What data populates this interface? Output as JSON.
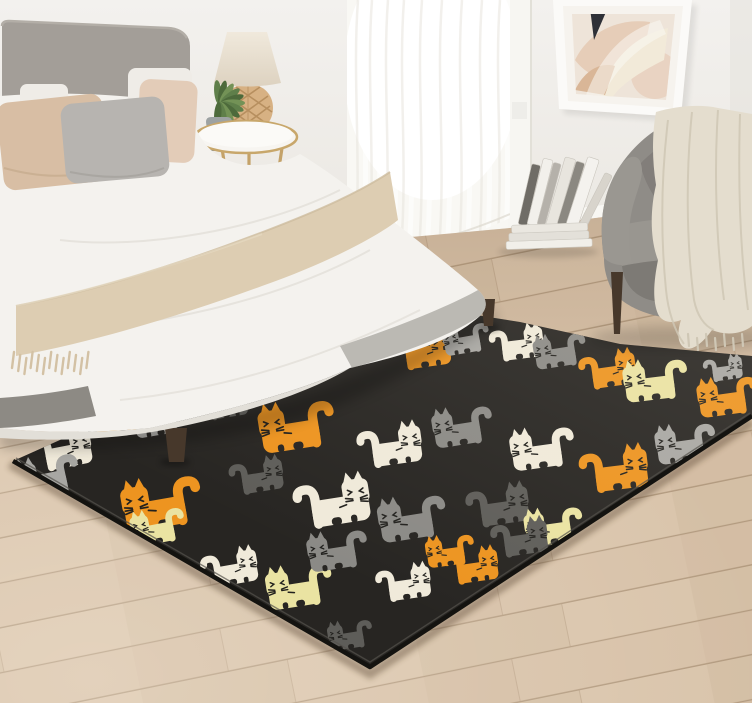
{
  "meta": {
    "description": "Photograph of a bright bedroom: grey upholstered bed with beige pillows and knit throw, round brass side table with rattan lamp and potted plant, sheer curtained window, abstract framed art, grey armchair with cream knit blanket, stacked books, light wood floor, and a large black area rug patterned with cartoon cats in orange, cream, yellow and grey."
  },
  "colors": {
    "wall": "#f1efeb",
    "wallShade": "#e4e1db",
    "floor": "#d4bda4",
    "floorLight": "#e0ccb4",
    "floorDark": "#c4ab90",
    "seam": "#b29a7f",
    "baseboard": "#f8f7f3",
    "curtain": "#f9f8f4",
    "trim": "#f7f6f2",
    "headboard": "#a39e98",
    "duvet": "#f4f2ee",
    "duvetShade": "#e2dfd8",
    "bedBase": "#8d8a84",
    "pillowTan": "#d8bea4",
    "pillowGray": "#b7b4b0",
    "pillowBlush": "#e3ccb8",
    "pillowWhite": "#efece7",
    "throwBed": "#ddcdb2",
    "fringe": "#d3c1a4",
    "tableTop": "#f7f5f1",
    "tableGold": "#c4a269",
    "lampShade": "#ece4d6",
    "lampBase": "#d7b183",
    "lampLattice": "#b28a59",
    "potGray": "#9da2a2",
    "plantGreen": "#5f7f4a",
    "plantGreenDark": "#4d6a3b",
    "plantGreenLight": "#739256",
    "chair": "#8f8c87",
    "chairShade": "#7d7a75",
    "chairSeat": "#999690",
    "legWood": "#47382b",
    "throwChair": "#e4ddce",
    "throwChairShade": "#cfc7b5",
    "artFrame": "#fbfaf8",
    "artMat": "#f6f3ee",
    "artTriangle": "#2e3037",
    "rugBlack": "#272522",
    "rugEdge": "#141310",
    "catFace": "#22211e",
    "shadow": "#000000"
  },
  "art": {
    "shapes": [
      "#e6cdb8",
      "#f2ead9",
      "#d9b697",
      "#e9d3c2"
    ]
  },
  "books": {
    "spines": [
      {
        "x": 518,
        "h": 62,
        "w": 9,
        "c": "#6f6c66",
        "r": 13
      },
      {
        "x": 527,
        "h": 68,
        "w": 10,
        "c": "#f2f0eb",
        "r": 14
      },
      {
        "x": 537,
        "h": 64,
        "w": 8,
        "c": "#b5b1aa",
        "r": 15
      },
      {
        "x": 546,
        "h": 70,
        "w": 11,
        "c": "#e8e5de",
        "r": 16
      },
      {
        "x": 557,
        "h": 66,
        "w": 9,
        "c": "#8b8881",
        "r": 17
      },
      {
        "x": 566,
        "h": 71,
        "w": 12,
        "c": "#f4f2ee",
        "r": 18
      },
      {
        "x": 579,
        "h": 58,
        "w": 8,
        "c": "#d8d4cc",
        "r": 27
      }
    ],
    "stack": [
      {
        "x": 506,
        "y": 240,
        "w": 86,
        "h": 8,
        "c": "#f1efe9"
      },
      {
        "x": 509,
        "y": 232,
        "w": 80,
        "h": 8,
        "c": "#e3e0d9"
      },
      {
        "x": 512,
        "y": 224,
        "w": 76,
        "h": 8,
        "c": "#eae7e0"
      }
    ]
  },
  "rug": {
    "background": "#272522",
    "clip": "13,461 375,299 520,322 620,344 752,356 752,416 370,667",
    "palette": {
      "orange": "#ed9420",
      "cream": "#f0eada",
      "yellow": "#eae3a2",
      "grayLight": "#a8a7a3",
      "grayMid": "#8b8a86",
      "grayDark": "#5e5d59"
    },
    "cats": [
      {
        "x": 420,
        "y": 352,
        "s": 0.6,
        "c": "orange",
        "f": 1,
        "r": -8
      },
      {
        "x": 468,
        "y": 340,
        "s": 0.48,
        "c": "grayLight",
        "f": 0,
        "r": -10
      },
      {
        "x": 515,
        "y": 345,
        "s": 0.55,
        "c": "cream",
        "f": 1,
        "r": -7
      },
      {
        "x": 562,
        "y": 352,
        "s": 0.54,
        "c": "grayMid",
        "f": 0,
        "r": -9
      },
      {
        "x": 606,
        "y": 372,
        "s": 0.58,
        "c": "orange",
        "f": 1,
        "r": -8
      },
      {
        "x": 658,
        "y": 382,
        "s": 0.66,
        "c": "yellow",
        "f": 0,
        "r": -7
      },
      {
        "x": 722,
        "y": 370,
        "s": 0.4,
        "c": "grayLight",
        "f": 1,
        "r": -8
      },
      {
        "x": 730,
        "y": 398,
        "s": 0.62,
        "c": "orange",
        "f": 0,
        "r": -8
      },
      {
        "x": 125,
        "y": 418,
        "s": 0.6,
        "c": "orange",
        "f": 0,
        "r": -10
      },
      {
        "x": 60,
        "y": 452,
        "s": 0.62,
        "c": "cream",
        "f": 1,
        "r": -11
      },
      {
        "x": 162,
        "y": 420,
        "s": 0.55,
        "c": "grayLight",
        "f": 0,
        "r": -10
      },
      {
        "x": 222,
        "y": 405,
        "s": 0.5,
        "c": "grayDark",
        "f": 1,
        "r": -9
      },
      {
        "x": 300,
        "y": 428,
        "s": 0.78,
        "c": "orange",
        "f": 0,
        "r": -9
      },
      {
        "x": 388,
        "y": 448,
        "s": 0.66,
        "c": "cream",
        "f": 1,
        "r": -8
      },
      {
        "x": 465,
        "y": 428,
        "s": 0.62,
        "c": "grayMid",
        "f": 0,
        "r": -9
      },
      {
        "x": 545,
        "y": 450,
        "s": 0.66,
        "c": "cream",
        "f": 0,
        "r": -8
      },
      {
        "x": 612,
        "y": 472,
        "s": 0.7,
        "c": "orange",
        "f": 1,
        "r": -7
      },
      {
        "x": 688,
        "y": 445,
        "s": 0.62,
        "c": "grayLight",
        "f": 0,
        "r": -8
      },
      {
        "x": 50,
        "y": 478,
        "s": 0.66,
        "c": "grayLight",
        "f": 0,
        "r": -12
      },
      {
        "x": 165,
        "y": 505,
        "s": 0.82,
        "c": "orange",
        "f": 0,
        "r": -10
      },
      {
        "x": 255,
        "y": 478,
        "s": 0.55,
        "c": "grayDark",
        "f": 1,
        "r": -9
      },
      {
        "x": 330,
        "y": 505,
        "s": 0.78,
        "c": "cream",
        "f": 1,
        "r": -9
      },
      {
        "x": 415,
        "y": 520,
        "s": 0.7,
        "c": "grayMid",
        "f": 0,
        "r": -9
      },
      {
        "x": 496,
        "y": 508,
        "s": 0.64,
        "c": "grayDark",
        "f": 1,
        "r": -8
      },
      {
        "x": 556,
        "y": 528,
        "s": 0.6,
        "c": "yellow",
        "f": 0,
        "r": -8
      },
      {
        "x": 470,
        "y": 568,
        "s": 0.55,
        "c": "orange",
        "f": 1,
        "r": -8
      },
      {
        "x": 160,
        "y": 528,
        "s": 0.56,
        "c": "yellow",
        "f": 0,
        "r": -11
      },
      {
        "x": 228,
        "y": 570,
        "s": 0.58,
        "c": "cream",
        "f": 1,
        "r": -10
      },
      {
        "x": 302,
        "y": 588,
        "s": 0.68,
        "c": "yellow",
        "f": 0,
        "r": -9
      },
      {
        "x": 340,
        "y": 552,
        "s": 0.62,
        "c": "grayMid",
        "f": 0,
        "r": -9
      },
      {
        "x": 402,
        "y": 585,
        "s": 0.56,
        "c": "cream",
        "f": 1,
        "r": -8
      },
      {
        "x": 452,
        "y": 552,
        "s": 0.5,
        "c": "orange",
        "f": 0,
        "r": -8
      },
      {
        "x": 518,
        "y": 540,
        "s": 0.58,
        "c": "grayDark",
        "f": 1,
        "r": -8
      },
      {
        "x": 352,
        "y": 636,
        "s": 0.46,
        "c": "grayDark",
        "f": 0,
        "r": -9
      }
    ]
  }
}
